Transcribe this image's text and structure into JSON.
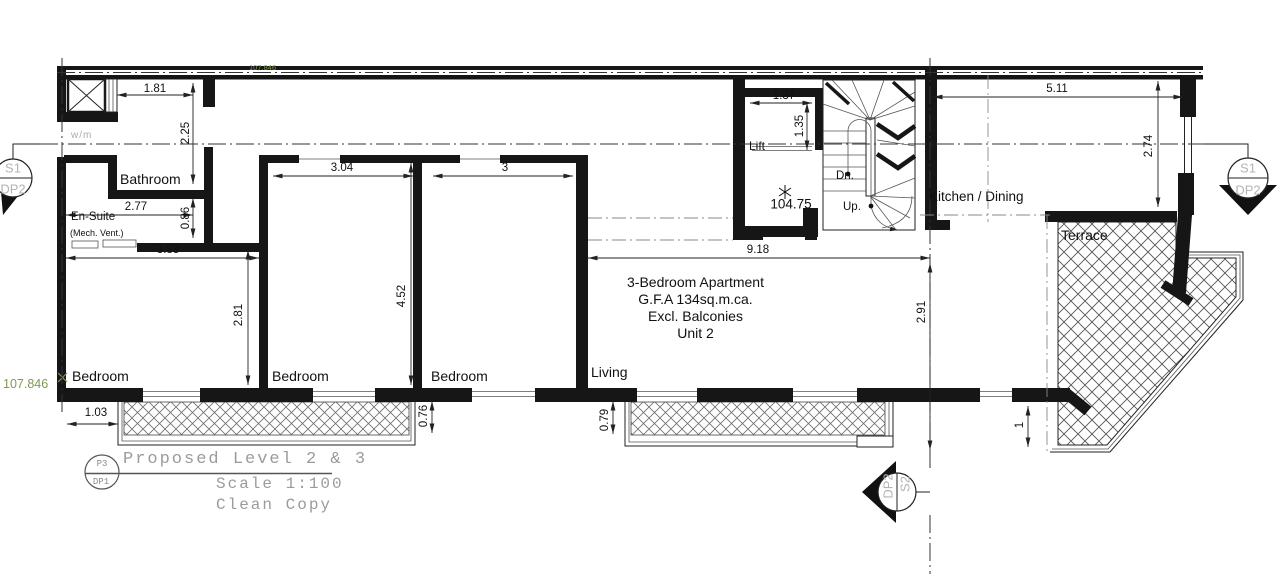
{
  "rooms": {
    "bathroom": "Bathroom",
    "ensuite": "En-Suite",
    "ensuite_note": "(Mech. Vent.)",
    "bedroom": "Bedroom",
    "living": "Living",
    "lift": "Lift",
    "kitchen": "Kitchen / Dining",
    "terrace": "Terrace",
    "wm": "w/m"
  },
  "stair": {
    "down": "Dn.",
    "up": "Up."
  },
  "levels": {
    "stair_landing": "104.75",
    "datum_left": "107.846",
    "datum_top": "107.846"
  },
  "unit_note": {
    "line1": "3-Bedroom Apartment",
    "line2": "G.F.A 134sq.m.ca.",
    "line3": "Excl. Balconies",
    "line4": "Unit 2"
  },
  "dims": {
    "shaft_w": "1.81",
    "hall_d": "2.25",
    "ensuite_w": "2.77",
    "bath_door": "0.86",
    "bed1_w": "3.83",
    "bed1_d": "2.81",
    "bed2_w": "3.04",
    "bed_depth": "4.52",
    "bed3_w": "3",
    "lift_w": "1.37",
    "lift_d": "1.35",
    "kitchen_w": "5.11",
    "kitchen_d": "2.74",
    "living_w": "9.18",
    "living_d": "2.91",
    "balc1_off": "1.03",
    "balc1_d": "0.76",
    "balc2_d": "0.79",
    "terrace_d": "1"
  },
  "markers": {
    "left": {
      "top": "S1",
      "bottom": "DP2"
    },
    "right": {
      "top": "S1",
      "bottom": "DP2"
    },
    "bottom": {
      "top": "S2",
      "bottom": "DP2"
    }
  },
  "titleblock": {
    "ref_top": "P3",
    "ref_bottom": "DP1",
    "title": "Proposed Level 2 & 3",
    "scale": "Scale 1:100",
    "note": "Clean Copy"
  }
}
